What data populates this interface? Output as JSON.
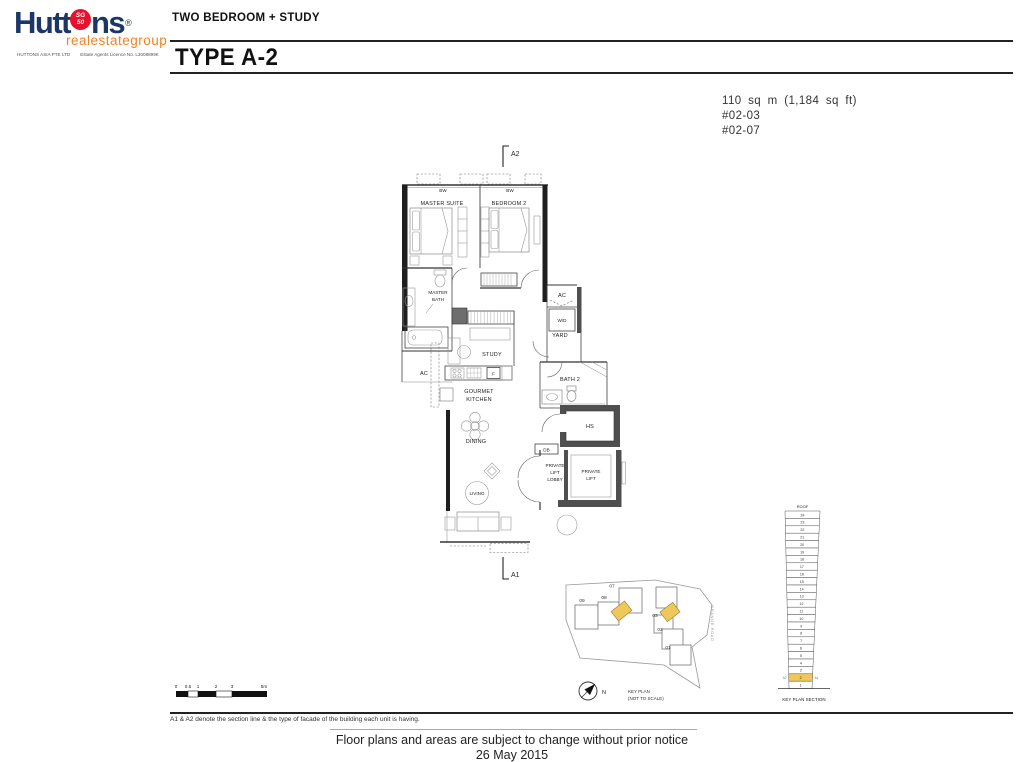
{
  "logo": {
    "brand_left": "Hutt",
    "brand_right": "ns",
    "registered": "®",
    "badge_line1": "SG",
    "badge_line2": "50",
    "subbrand": "realestategroup",
    "company": "HUTTONS ASIA PTE LTD",
    "licence": "Estate Agents Licence No. L3008899K"
  },
  "header": {
    "unit_type": "TWO BEDROOM + STUDY",
    "plan_type": "TYPE A-2"
  },
  "unit_info": {
    "area": "110 sq m (1,184 sq ft)",
    "unit_1": "#02-03",
    "unit_2": "#02-07"
  },
  "floor_plan": {
    "markers": {
      "top": "A2",
      "bottom": "A1"
    },
    "labels": {
      "bw_master": "BW",
      "bw_bedroom2": "BW",
      "master_suite": "MASTER SUITE",
      "bedroom_2": "BEDROOM 2",
      "master_bath_1": "MASTER",
      "master_bath_2": "BATH",
      "ac_left": "AC",
      "study": "STUDY",
      "kitchen_1": "GOURMET",
      "kitchen_2": "KITCHEN",
      "fridge": "F",
      "dining": "DINING",
      "living": "LIVING",
      "ac_right": "AC",
      "washer_dryer": "W/D",
      "yard": "YARD",
      "bath_2": "BATH 2",
      "household_shelter": "HS",
      "db": "DB",
      "lift_lobby_1": "PRIVATE",
      "lift_lobby_2": "LIFT",
      "lift_lobby_3": "LOBBY",
      "private_lift_1": "PRIVATE",
      "private_lift_2": "LIFT"
    }
  },
  "scale_bar": {
    "labels": [
      "0",
      "0.5",
      "1",
      "2",
      "3",
      "5m"
    ]
  },
  "key_plan": {
    "title": "KEY PLAN",
    "subtitle": "(NOT TO SCALE)",
    "north": "N",
    "road": "GRANGE ROAD",
    "stacks": [
      "09",
      "08",
      "07",
      "03",
      "02",
      "01"
    ]
  },
  "key_plan_section": {
    "caption": "KEY PLAN SECTION",
    "roof": "ROOF",
    "floors": [
      "24",
      "23",
      "22",
      "21",
      "20",
      "19",
      "18",
      "17",
      "16",
      "15",
      "14",
      "13",
      "12",
      "11",
      "10",
      "9",
      "8",
      "7",
      "6",
      "5",
      "4",
      "3",
      "2",
      "1"
    ],
    "highlighted_floor": "2",
    "marker_left": "A2",
    "marker_right": "A1"
  },
  "notes": {
    "facade_note": "A1 & A2 denote the section line & the type of facade of the building each unit is having.",
    "disclaimer": "Floor plans and areas are subject to change without prior notice",
    "date": "26 May 2015"
  },
  "colors": {
    "brand_navy": "#1c3667",
    "brand_red": "#e8112d",
    "brand_orange": "#f58220",
    "unit_highlight": "#f0c75a",
    "wall_black": "#1f1f1f",
    "shelter_wall_gray": "#555555"
  }
}
